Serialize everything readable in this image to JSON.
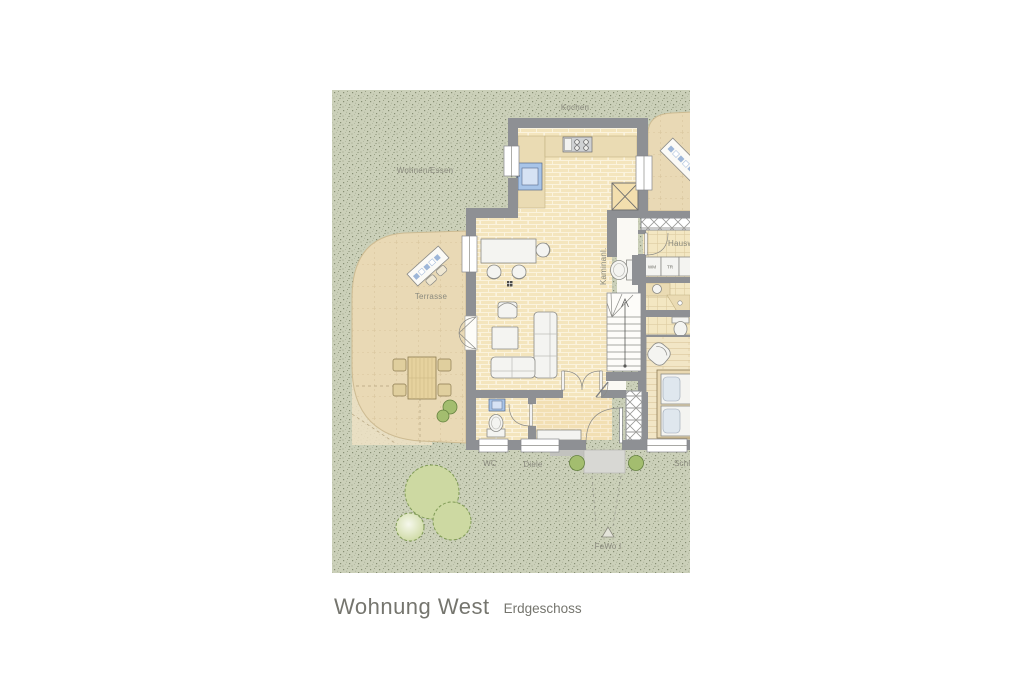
{
  "title": {
    "main": "Wohnung West",
    "sub": "Erdgeschoss"
  },
  "plan": {
    "unit_label": "FeWo I",
    "rooms": {
      "kitchen": "Kochen",
      "living_dining": "Wohnen/Essen",
      "terrace": "Terrasse",
      "chimney": "Kaminanl.",
      "utility": "Hauswirtschaft",
      "wc": "WC",
      "hall": "Diele",
      "bedroom": "Schlafen"
    },
    "appliances": {
      "washer": "WM",
      "dryer": "TR"
    },
    "colors": {
      "grass": "#cbd0b9",
      "terrace": "#e9d9b5",
      "floor_brick": "#f4e5bd",
      "wall": "#8e9094",
      "fixture_blue": "#a8c4e8",
      "bush": "#a3bd6f",
      "tree": "#cdd9a2",
      "label": "#8a8a7e"
    }
  }
}
